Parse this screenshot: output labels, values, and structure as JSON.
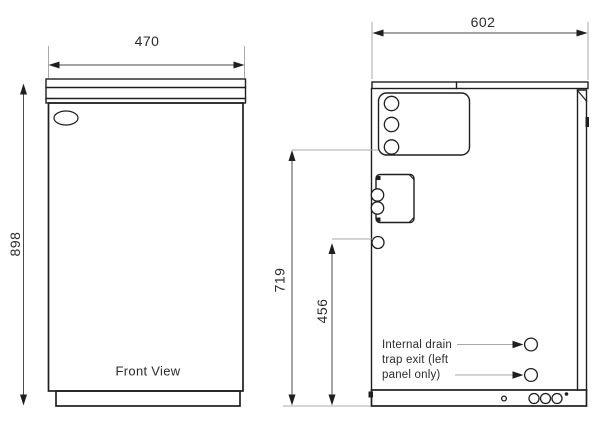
{
  "colors": {
    "line": "#1f1f1f",
    "leader": "#a8a8a8",
    "green": "#12883e"
  },
  "front_view": {
    "caption": "Front View",
    "width_mm": "470",
    "height_mm": "898"
  },
  "side_view": {
    "width_mm": "602",
    "upper_height_mm": "719",
    "drain_height_mm": "456",
    "note_line1": "Internal drain",
    "note_line2": "trap exit (left",
    "note_line3": "panel only)"
  }
}
